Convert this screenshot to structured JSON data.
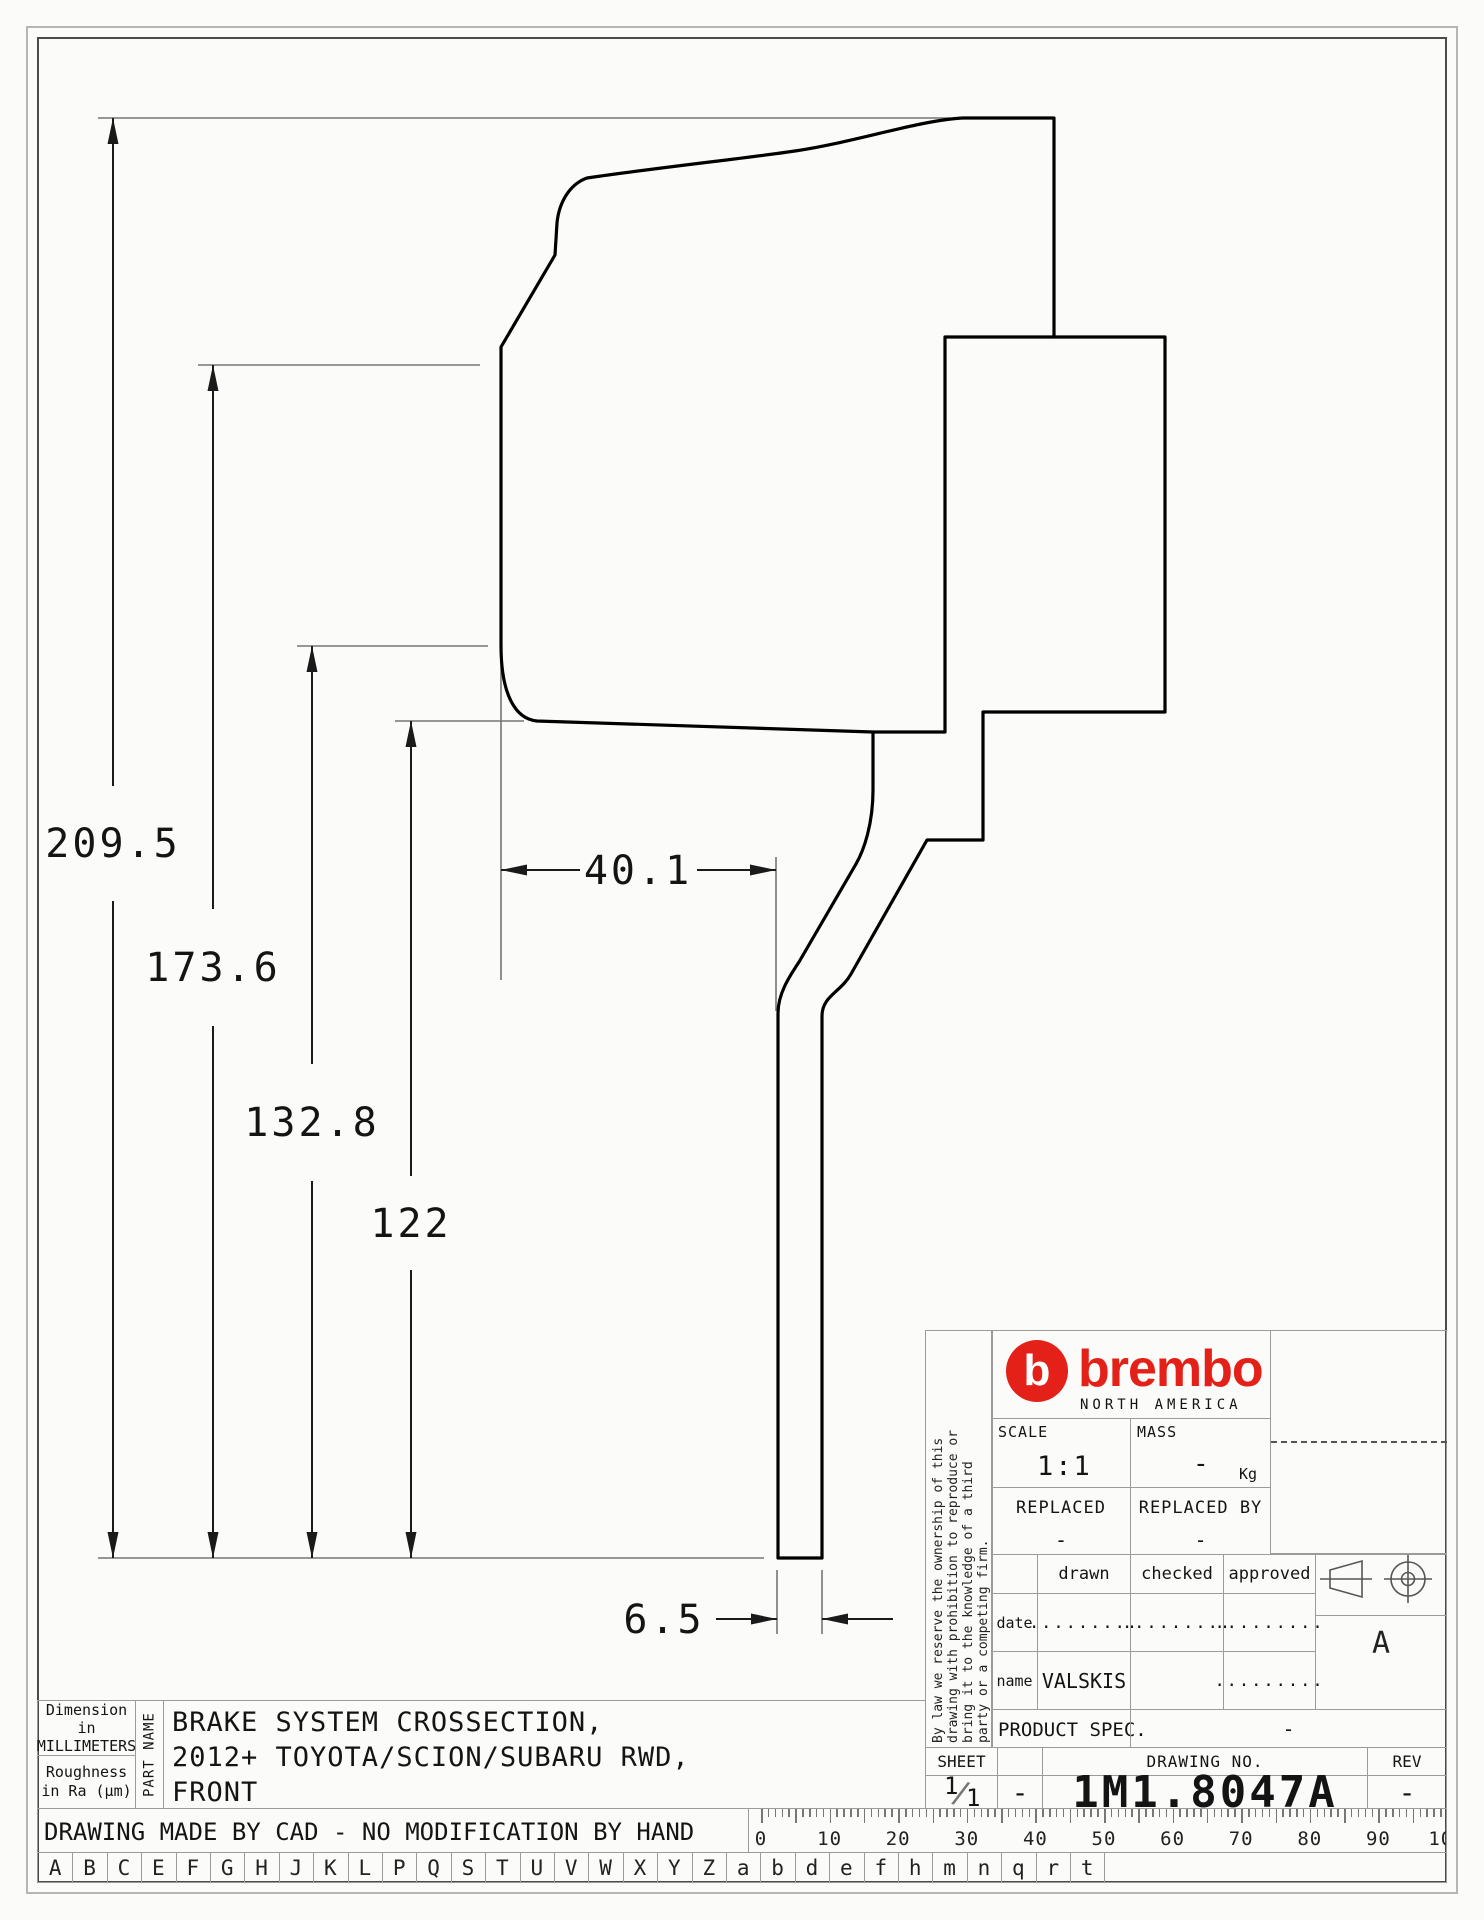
{
  "dims": {
    "total_height": "209.5",
    "upper_height": "173.6",
    "mid_height": "132.8",
    "flange_height": "122",
    "hat_depth": "40.1",
    "disc_thickness": "6.5"
  },
  "info_left": {
    "dimension_note": "Dimension\nin MILLIMETERS",
    "roughness_note": "Roughness\nin Ra (µm)",
    "part_name_label": "PART NAME",
    "part_name_lines": [
      "BRAKE SYSTEM CROSSECTION,",
      "2012+ TOYOTA/SCION/SUBARU RWD,",
      "FRONT"
    ],
    "cad_note": "DRAWING MADE BY CAD - NO MODIFICATION BY HAND"
  },
  "title_block": {
    "disclaimer_lines": [
      "By law we reserve the ownership of this",
      "drawing with prohibition to reproduce or",
      "bring it to the knowledge of a third",
      "party or a competing firm."
    ],
    "brand": {
      "mark_letter": "b",
      "wordmark": "brembo",
      "subtitle": "NORTH AMERICA",
      "red": "#e32119"
    },
    "scale_label": "SCALE",
    "scale_value": "1:1",
    "mass_label": "MASS",
    "mass_value": "-",
    "mass_unit": "Kg",
    "replaced_label": "REPLACED",
    "replaced_value": "-",
    "replaced_by_label": "REPLACED BY",
    "replaced_by_value": "-",
    "sig_table": {
      "col_headers": [
        "drawn",
        "checked",
        "approved"
      ],
      "date_label": "date",
      "name_label": "name",
      "date_values": [
        ".........",
        ".........",
        "........."
      ],
      "name_values": [
        "VALSKIS",
        "",
        "........."
      ]
    },
    "product_spec_label": "PRODUCT SPEC.",
    "product_spec_value": "-",
    "paper_symbol": "A",
    "sheet_label": "SHEET",
    "sheet_num": "1",
    "sheet_total": "1",
    "sheet_sep": "-",
    "drawing_no_label": "DRAWING NO.",
    "drawing_no": "1M1.8047A",
    "rev_label": "REV",
    "rev_value": "-"
  },
  "ruler": {
    "labels": [
      "0",
      "10",
      "20",
      "30",
      "40",
      "50",
      "60",
      "70",
      "80",
      "90",
      "100"
    ]
  },
  "letter_strip": [
    "A",
    "B",
    "C",
    "E",
    "F",
    "G",
    "H",
    "J",
    "K",
    "L",
    "P",
    "Q",
    "S",
    "T",
    "U",
    "V",
    "W",
    "X",
    "Y",
    "Z",
    "a",
    "b",
    "d",
    "e",
    "f",
    "h",
    "m",
    "n",
    "q",
    "r",
    "t"
  ]
}
